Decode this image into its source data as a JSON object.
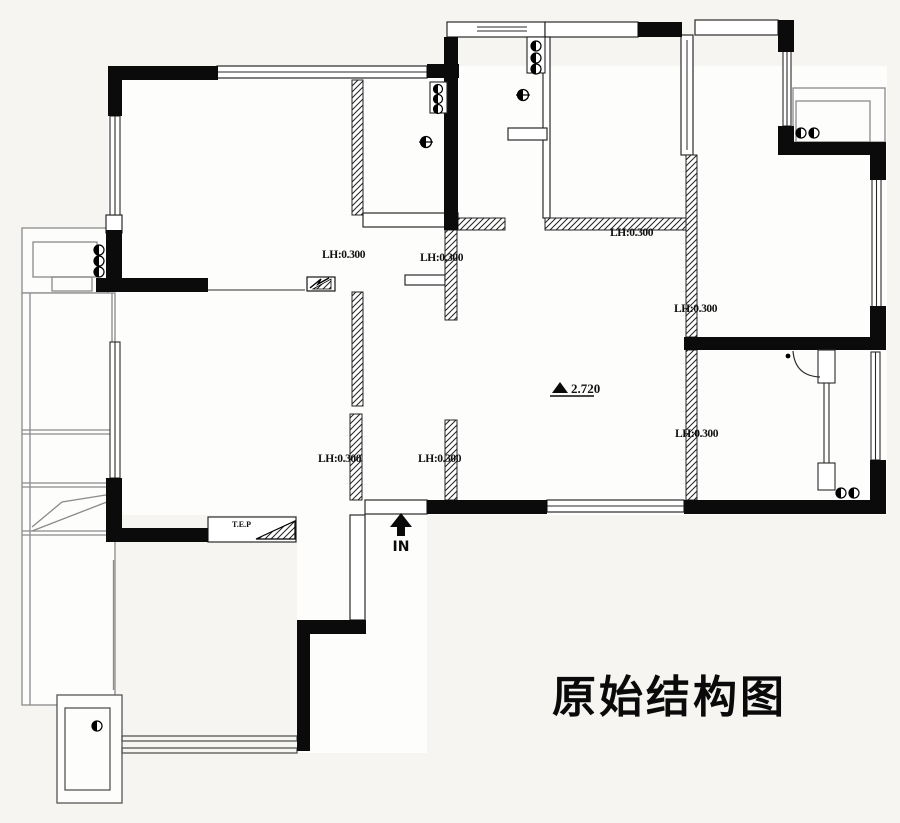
{
  "plan": {
    "title": "原始结构图",
    "entrance_label": "IN",
    "elevation_label": "2.720",
    "sill_label": "T.E.P",
    "beam_labels": [
      "LH:0.300",
      "LH:0.300",
      "LH:0.300",
      "LH:0.300",
      "LH:0.300",
      "LH:0.300",
      "LH:0.300"
    ]
  },
  "symbols": {
    "floor_drain": "floor-drain",
    "pipe_riser": "pipe-riser-stack",
    "electric_panel": "electric-panel",
    "entrance_arrow": "up-arrow",
    "elevation_marker": "filled-triangle"
  },
  "colors": {
    "background": "#f6f5f2",
    "wall_fill": "#0b0b0b",
    "thin_line": "#2a2a2a",
    "light_line": "#8a8a8a"
  }
}
